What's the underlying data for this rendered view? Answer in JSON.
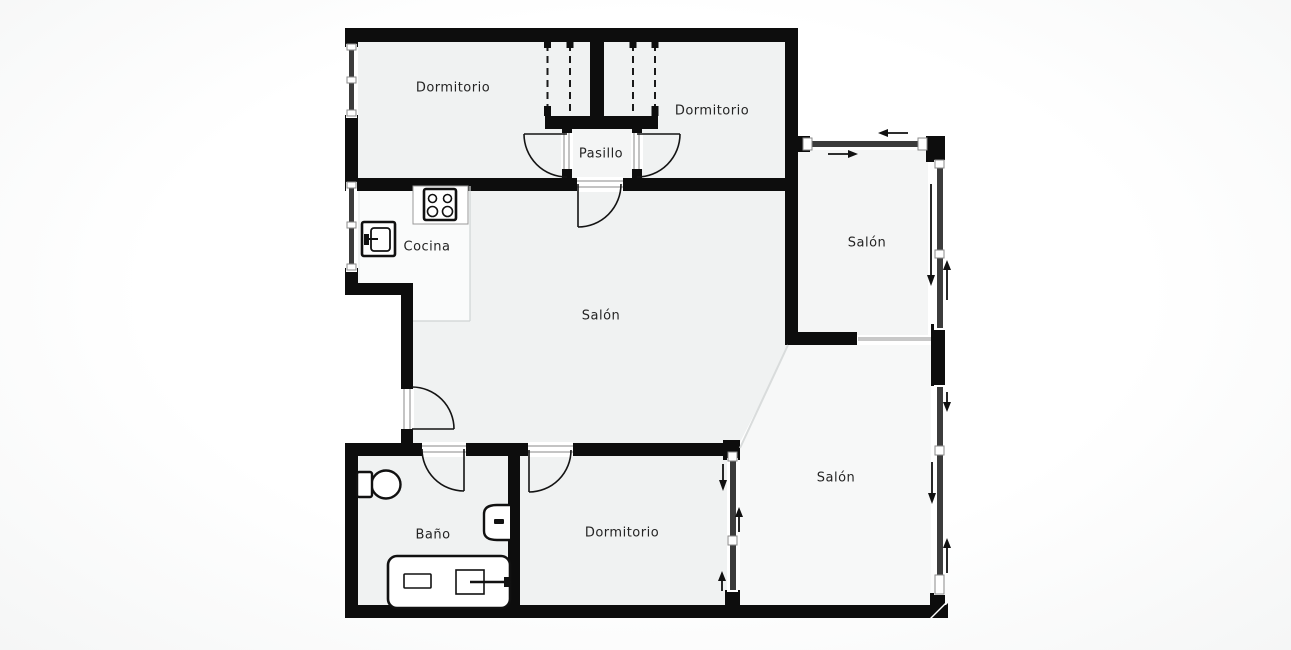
{
  "title": "Apartment floor plan",
  "labels": {
    "dormitorio_tl": "Dormitorio",
    "dormitorio_tr": "Dormitorio",
    "pasillo": "Pasillo",
    "cocina": "Cocina",
    "salon_center": "Salón",
    "salon_top_right": "Salón",
    "salon_bottom_right": "Salón",
    "bano": "Baño",
    "dormitorio_bottom": "Dormitorio"
  },
  "colors": {
    "wall": "#0d0d0d",
    "floor": "#f0f2f2",
    "floor_light": "#f7f8f8",
    "floor_mid": "#f4f5f5",
    "kitchen_zone": "#fafbfb",
    "window_glass": "#3c3c3c",
    "threshold": "#c8c8c8",
    "label_text": "#242424",
    "background": "#ffffff"
  },
  "icons": [
    "stove-icon",
    "appliance-icon",
    "toilet-icon",
    "bidet-icon",
    "bathtub-icon",
    "door-swing-arc",
    "sliding-direction-arrow",
    "window-symbol",
    "wardrobe-dashed-line"
  ]
}
